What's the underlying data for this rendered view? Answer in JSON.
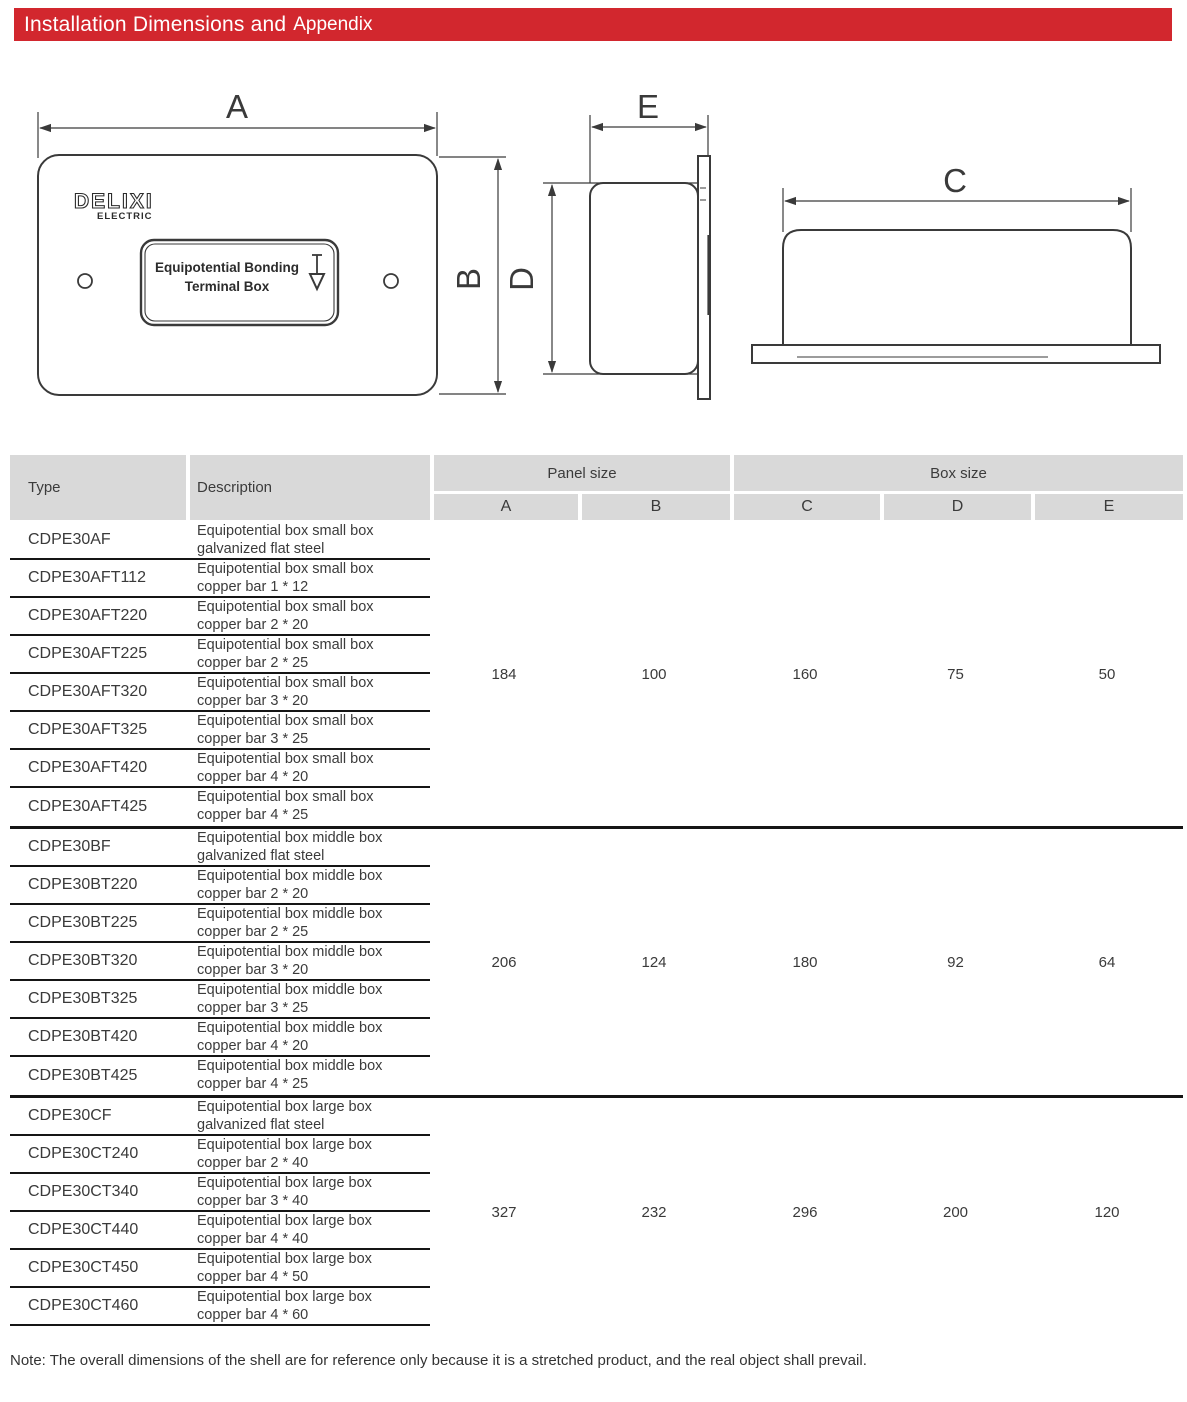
{
  "header": {
    "title_main": "Installation Dimensions and",
    "title_appendix": "Appendix",
    "bar_color": "#d2272e"
  },
  "diagram": {
    "labels": {
      "a": "A",
      "b": "B",
      "c": "C",
      "d": "D",
      "e": "E"
    },
    "logo": {
      "line1": "DELIXI",
      "line2": "ELECTRIC"
    },
    "panel_label": {
      "line1": "Equipotential Bonding",
      "line2": "Terminal Box"
    },
    "ground_symbol": "earth-ground-arrow"
  },
  "table": {
    "headers": {
      "type": "Type",
      "description": "Description",
      "panel_size": "Panel size",
      "box_size": "Box size",
      "cols": [
        "A",
        "B",
        "C",
        "D",
        "E"
      ],
      "header_bg": "#d9d9d9"
    },
    "groups": [
      {
        "values": [
          "184",
          "100",
          "160",
          "75",
          "50"
        ],
        "rows": [
          {
            "type": "CDPE30AF",
            "desc1": "Equipotential box small box",
            "desc2": "galvanized flat steel"
          },
          {
            "type": "CDPE30AFT112",
            "desc1": "Equipotential box small box",
            "desc2": "copper bar 1 * 12"
          },
          {
            "type": "CDPE30AFT220",
            "desc1": "Equipotential box small box",
            "desc2": "copper bar 2 * 20"
          },
          {
            "type": "CDPE30AFT225",
            "desc1": "Equipotential box small box",
            "desc2": "copper bar 2 * 25"
          },
          {
            "type": "CDPE30AFT320",
            "desc1": "Equipotential box small box",
            "desc2": "copper bar 3 * 20"
          },
          {
            "type": "CDPE30AFT325",
            "desc1": "Equipotential box small box",
            "desc2": "copper bar 3 * 25"
          },
          {
            "type": "CDPE30AFT420",
            "desc1": "Equipotential box small box",
            "desc2": "copper bar 4 * 20"
          },
          {
            "type": "CDPE30AFT425",
            "desc1": "Equipotential box small box",
            "desc2": "copper bar 4 * 25"
          }
        ]
      },
      {
        "values": [
          "206",
          "124",
          "180",
          "92",
          "64"
        ],
        "rows": [
          {
            "type": "CDPE30BF",
            "desc1": "Equipotential box middle box",
            "desc2": "galvanized flat steel"
          },
          {
            "type": "CDPE30BT220",
            "desc1": "Equipotential box middle box",
            "desc2": "copper bar 2 * 20"
          },
          {
            "type": "CDPE30BT225",
            "desc1": "Equipotential box middle box",
            "desc2": "copper bar 2 * 25"
          },
          {
            "type": "CDPE30BT320",
            "desc1": "Equipotential box middle box",
            "desc2": "copper bar 3 * 20"
          },
          {
            "type": "CDPE30BT325",
            "desc1": "Equipotential box middle box",
            "desc2": "copper bar 3 * 25"
          },
          {
            "type": "CDPE30BT420",
            "desc1": "Equipotential box middle box",
            "desc2": "copper bar 4 * 20"
          },
          {
            "type": "CDPE30BT425",
            "desc1": "Equipotential box middle box",
            "desc2": "copper bar 4 * 25"
          }
        ]
      },
      {
        "values": [
          "327",
          "232",
          "296",
          "200",
          "120"
        ],
        "rows": [
          {
            "type": "CDPE30CF",
            "desc1": "Equipotential box large box",
            "desc2": "galvanized flat steel"
          },
          {
            "type": "CDPE30CT240",
            "desc1": "Equipotential box large box",
            "desc2": "copper bar 2 * 40"
          },
          {
            "type": "CDPE30CT340",
            "desc1": "Equipotential box large box",
            "desc2": "copper bar 3 * 40"
          },
          {
            "type": "CDPE30CT440",
            "desc1": "Equipotential box large box",
            "desc2": "copper bar 4 * 40"
          },
          {
            "type": "CDPE30CT450",
            "desc1": "Equipotential box large box",
            "desc2": "copper bar 4 * 50"
          },
          {
            "type": "CDPE30CT460",
            "desc1": "Equipotential box large box",
            "desc2": "copper bar 4 * 60"
          }
        ]
      }
    ]
  },
  "note": "Note: The overall dimensions of the shell are for reference only because it is a stretched product, and the real object shall prevail."
}
